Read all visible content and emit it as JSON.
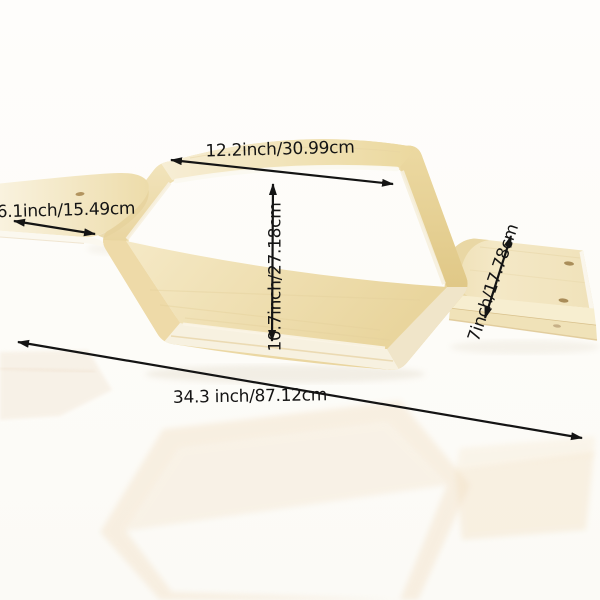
{
  "labels": {
    "top_width": "12.2inch/30.99cm",
    "left_shelf_depth": "6.1inch/15.49cm",
    "inner_height": "10.7inch/27.18cm",
    "right_shelf_depth": "7inch/17.78cm",
    "overall_length": "34.3 inch/87.12cm"
  },
  "colors": {
    "background": "#fdfcf8",
    "wood_light": "#f7eed6",
    "wood_mid": "#efdfad",
    "wood_dark": "#e4cd8f",
    "edge_cream": "#f8f3e3",
    "annotation": "#141414"
  }
}
